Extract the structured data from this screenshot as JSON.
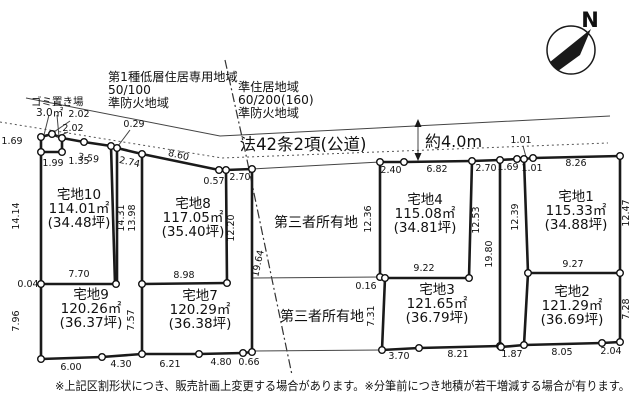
{
  "colors": {
    "ink": "#1a1a1a",
    "thin": "#444444",
    "bg": "#ffffff"
  },
  "north_label": "N",
  "zoning_left": {
    "lines": [
      "第1種低層住居専用地域",
      "50/100",
      "準防火地域"
    ]
  },
  "zoning_right": {
    "lines": [
      "準住居地域",
      "60/200(160)",
      "準防火地域"
    ]
  },
  "road": {
    "name": "法42条2項(公道)",
    "width": "約4.0m"
  },
  "garbage_area": {
    "name": "ゴミ置き場",
    "size": "3.0㎡"
  },
  "third_party_upper": "第三者所有地",
  "third_party_lower": "第三者所有地",
  "note": "※上記区割形状につき、販売計画上変更する場合があります。※分筆前につき地積が若干増減する場合が有ります。",
  "lots": [
    {
      "name": "宅地1",
      "area": "115.33㎡",
      "tsubo": "(34.88坪)",
      "x": 576,
      "y": 201
    },
    {
      "name": "宅地2",
      "area": "121.29㎡",
      "tsubo": "(36.69坪)",
      "x": 572,
      "y": 296
    },
    {
      "name": "宅地3",
      "area": "121.65㎡",
      "tsubo": "(36.79坪)",
      "x": 437,
      "y": 294
    },
    {
      "name": "宅地4",
      "area": "115.08㎡",
      "tsubo": "(34.81坪)",
      "x": 425,
      "y": 204
    },
    {
      "name": "宅地7",
      "area": "120.29㎡",
      "tsubo": "(36.38坪)",
      "x": 200,
      "y": 300
    },
    {
      "name": "宅地8",
      "area": "117.05㎡",
      "tsubo": "(35.40坪)",
      "x": 193,
      "y": 208
    },
    {
      "name": "宅地9",
      "area": "120.26㎡",
      "tsubo": "(36.37坪)",
      "x": 91,
      "y": 299
    },
    {
      "name": "宅地10",
      "area": "114.01㎡",
      "tsubo": "(34.48坪)",
      "x": 79,
      "y": 199
    }
  ],
  "dimensions": [
    {
      "v": "1.69",
      "x": 12,
      "y": 144
    },
    {
      "v": "2.02",
      "x": 79,
      "y": 117
    },
    {
      "v": "2.02",
      "x": 73,
      "y": 131
    },
    {
      "v": "1.99",
      "x": 53,
      "y": 166
    },
    {
      "v": "1.35",
      "x": 79,
      "y": 164
    },
    {
      "v": "3.59",
      "x": 88,
      "y": 161,
      "r": 9
    },
    {
      "v": "0.29",
      "x": 134,
      "y": 127
    },
    {
      "v": "2.74",
      "x": 129,
      "y": 165,
      "r": 12
    },
    {
      "v": "8.60",
      "x": 178,
      "y": 158,
      "r": 12
    },
    {
      "v": "0.57",
      "x": 214,
      "y": 184
    },
    {
      "v": "2.70",
      "x": 240,
      "y": 180
    },
    {
      "v": "14.14",
      "x": 19,
      "y": 216,
      "r": -90
    },
    {
      "v": "14.31",
      "x": 124,
      "y": 218,
      "r": -90
    },
    {
      "v": "13.98",
      "x": 135,
      "y": 218,
      "r": -90
    },
    {
      "v": "12.20",
      "x": 234,
      "y": 228,
      "r": -90
    },
    {
      "v": "19.64",
      "x": 261,
      "y": 264,
      "r": -78
    },
    {
      "v": "7.70",
      "x": 79,
      "y": 277
    },
    {
      "v": "0.04",
      "x": 28,
      "y": 287
    },
    {
      "v": "7.96",
      "x": 19,
      "y": 321,
      "r": -90
    },
    {
      "v": "7.57",
      "x": 134,
      "y": 320,
      "r": -90
    },
    {
      "v": "6.00",
      "x": 71,
      "y": 370
    },
    {
      "v": "4.30",
      "x": 121,
      "y": 367
    },
    {
      "v": "6.21",
      "x": 170,
      "y": 367
    },
    {
      "v": "4.80",
      "x": 221,
      "y": 365
    },
    {
      "v": "0.66",
      "x": 249,
      "y": 365
    },
    {
      "v": "8.98",
      "x": 184,
      "y": 278
    },
    {
      "v": "2.40",
      "x": 391,
      "y": 173
    },
    {
      "v": "6.82",
      "x": 437,
      "y": 172
    },
    {
      "v": "12.36",
      "x": 371,
      "y": 219,
      "r": -90
    },
    {
      "v": "12.53",
      "x": 479,
      "y": 220,
      "r": -90
    },
    {
      "v": "9.22",
      "x": 424,
      "y": 271
    },
    {
      "v": "0.16",
      "x": 366,
      "y": 289
    },
    {
      "v": "7.31",
      "x": 374,
      "y": 316,
      "r": -90
    },
    {
      "v": "19.80",
      "x": 492,
      "y": 254,
      "r": -90
    },
    {
      "v": "3.70",
      "x": 399,
      "y": 359
    },
    {
      "v": "8.21",
      "x": 458,
      "y": 357
    },
    {
      "v": "1.87",
      "x": 512,
      "y": 357
    },
    {
      "v": "8.05",
      "x": 562,
      "y": 355
    },
    {
      "v": "2.04",
      "x": 611,
      "y": 354
    },
    {
      "v": "2.70",
      "x": 486,
      "y": 171
    },
    {
      "v": "1.69",
      "x": 508,
      "y": 170
    },
    {
      "v": "1.01",
      "x": 521,
      "y": 143
    },
    {
      "v": "1.01",
      "x": 532,
      "y": 171
    },
    {
      "v": "8.26",
      "x": 576,
      "y": 166
    },
    {
      "v": "12.39",
      "x": 518,
      "y": 217,
      "r": -90
    },
    {
      "v": "12.47",
      "x": 629,
      "y": 213,
      "r": -90
    },
    {
      "v": "9.27",
      "x": 573,
      "y": 267
    },
    {
      "v": "7.28",
      "x": 629,
      "y": 309,
      "r": -90
    }
  ]
}
